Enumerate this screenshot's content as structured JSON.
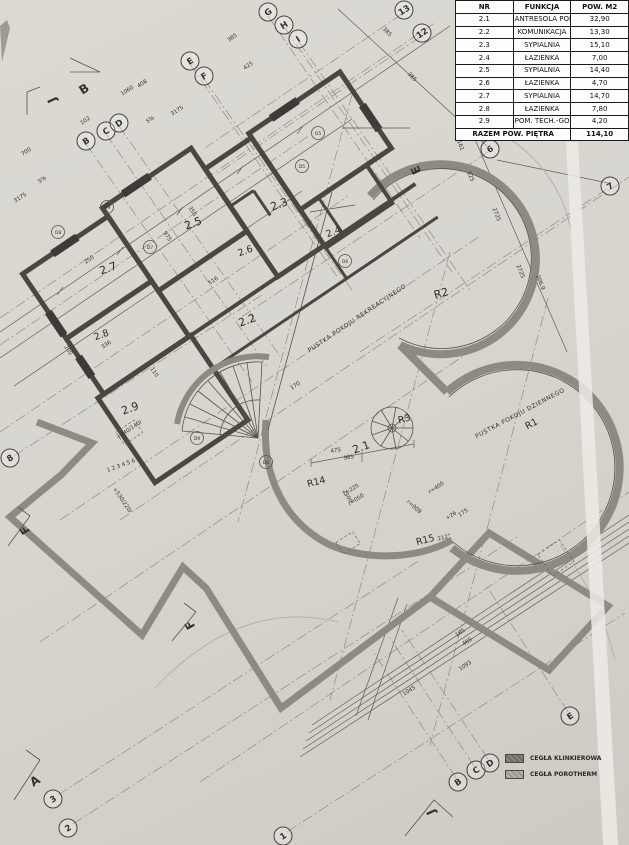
{
  "table": {
    "headers": [
      "NR",
      "FUNKCJA",
      "POW. M2"
    ],
    "rows": [
      {
        "nr": "2.1",
        "funkcja": "ANTRESOLA POK. DZIENNEGO",
        "pow": "32,90"
      },
      {
        "nr": "2.2",
        "funkcja": "KOMUNIKACJA",
        "pow": "13,30"
      },
      {
        "nr": "2.3",
        "funkcja": "SYPIALNIA",
        "pow": "15,10"
      },
      {
        "nr": "2.4",
        "funkcja": "ŁAZIENKA",
        "pow": "7,00"
      },
      {
        "nr": "2.5",
        "funkcja": "SYPIALNIA",
        "pow": "14,40"
      },
      {
        "nr": "2.6",
        "funkcja": "ŁAZIENKA",
        "pow": "4,70"
      },
      {
        "nr": "2.7",
        "funkcja": "SYPIALNIA",
        "pow": "14,70"
      },
      {
        "nr": "2.8",
        "funkcja": "ŁAZIENKA",
        "pow": "7,80"
      },
      {
        "nr": "2.9",
        "funkcja": "POM. TECH.-GOSPODARCZE",
        "pow": "4,20"
      }
    ],
    "total_label": "RAZEM POW. PIĘTRA",
    "total_value": "114,10"
  },
  "legend": {
    "items": [
      {
        "label": "CEGŁA KLINKIEROWA"
      },
      {
        "label": "CEGŁA POROTHERM"
      }
    ]
  },
  "labels": {
    "r2_1": "2.1",
    "r2_2": "2.2",
    "r2_3": "2.3",
    "r2_4": "2.4",
    "r2_5": "2.5",
    "r2_6": "2.6",
    "r2_7": "2.7",
    "r2_8": "2.8",
    "r2_9": "2.9",
    "rr1": "R1",
    "rr2": "R2",
    "rr3": "R3",
    "rr14": "R14",
    "rr15": "R15",
    "void_rekreacyjnego": "PUSTKA POKOJU REKREACYJNEGO",
    "void_dziennego": "PUSTKA POKOJU DZIENNEGO"
  },
  "bubbles": {
    "bB": "B",
    "bC": "C",
    "bD": "D",
    "bE": "E",
    "bF": "F",
    "bG": "G",
    "bH": "H",
    "bI": "I",
    "n1": "1",
    "n2": "2",
    "n3": "3",
    "n6": "6",
    "n7": "7",
    "n8": "8",
    "n12": "12",
    "n13": "13"
  },
  "markers": {
    "secA": "A",
    "secB": "B",
    "secE": "E",
    "secF": "F",
    "secJ": "J",
    "stair_numbers": "1 2 3 4 5 6 7",
    "level_a": "+440/140/",
    "level_b": "+530/220/",
    "deg": "212°"
  },
  "codes": {
    "c1": "O8",
    "c2": "O9",
    "c3": "D7",
    "c4": "O5",
    "c5": "D5",
    "c6": "O6",
    "c7": "D9",
    "c8": "D6"
  },
  "dims": {
    "d01": "385",
    "d02": "1060",
    "d03": "408",
    "d04": "425",
    "d05": "700",
    "d06": "102",
    "d07": "5%",
    "d08": "5%",
    "d09": "3175",
    "d10": "3175",
    "d11": "385",
    "d12": "385",
    "d13": "161",
    "d14": "525",
    "d15": "2725",
    "d16": "2725",
    "d17": "206.9",
    "d18": "475",
    "d19": "985",
    "d20": "2300",
    "d21": "r=225",
    "d22": "r=050",
    "d23": "r=008",
    "d24": "r=400",
    "d25": "175",
    "d26": "+26",
    "d27": "1093",
    "d28": "1045",
    "d29": "465",
    "d30": "165",
    "d31": "200",
    "d32": "336",
    "d33": "975",
    "d34": "355",
    "d35": "516",
    "d36": "250",
    "d37": "170",
    "d38": "110"
  },
  "colors": {
    "paper": "#d8d5cf",
    "wall_gray": "#8d8a82",
    "wall_dark": "#4a4741",
    "ink": "#33312c",
    "table_bg": "#fdfdfc"
  }
}
